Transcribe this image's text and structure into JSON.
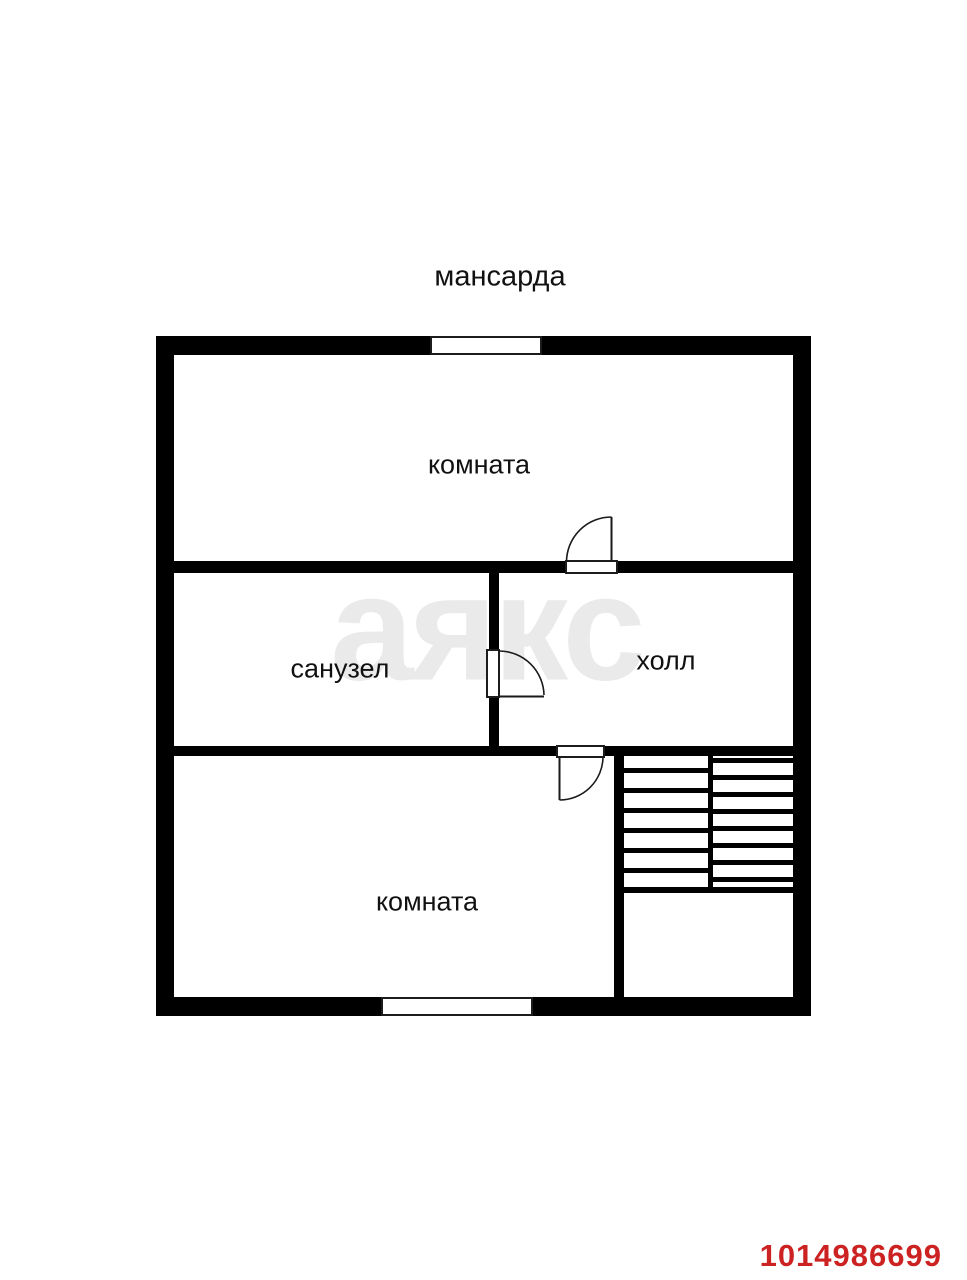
{
  "floorplan": {
    "title": "мансарда",
    "watermark": "аякс",
    "listing_id": "1014986699",
    "colors": {
      "walls": "#000000",
      "background": "#ffffff",
      "watermark": "#eaeaea",
      "listing_id": "#cc2222"
    },
    "rooms": [
      {
        "name": "room-top",
        "label": "комната"
      },
      {
        "name": "bathroom",
        "label": "санузел"
      },
      {
        "name": "hall",
        "label": "холл"
      },
      {
        "name": "room-bottom",
        "label": "комната"
      }
    ],
    "features": {
      "windows": 2,
      "doors": 3
    },
    "stairs": {
      "left_treads": 6,
      "right_treads": 8
    }
  }
}
